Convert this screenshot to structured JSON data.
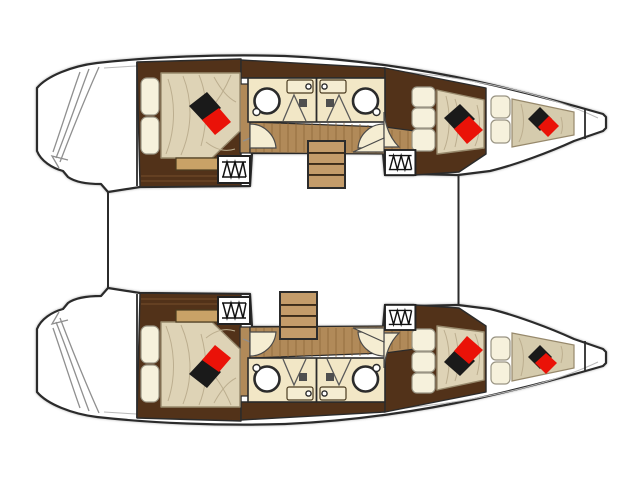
{
  "title": "Catamaran layout plan",
  "palette": {
    "line": "#2b2b2b",
    "hull_white": "#ffffff",
    "wenge": "#523219",
    "wenge_light": "#7a5230",
    "wood_mid": "#b18a59",
    "wood_grain": "#8a6335",
    "wood_step": "#c49c6a",
    "bench_wood": "#c9a267",
    "cream": "#f2e7c6",
    "door_cream": "#f5edd2",
    "mattress": "#ded3b6",
    "mattress_shade": "#bcae8f",
    "forepeak_pad": "#d5cbad",
    "pillow": "#f6f1dc",
    "pillow_line": "#9a9584",
    "cushion_black": "#1a1a1a",
    "cushion_red": "#ea1208",
    "square_gray": "#4f4f4f",
    "sketch_gray": "#8f8f8f"
  },
  "diagram": {
    "type": "yacht-deck-plan",
    "vessel": "sailing catamaran",
    "view": "top-down",
    "bows_facing": "right",
    "hulls": [
      {
        "id": "upper-hull",
        "rooms": [
          "stern platform with sketched steps",
          "aft double cabin",
          "aft bathroom with basin and shower",
          "forward bathroom with basin and shower",
          "corridor",
          "companionway stairs",
          "forward double cabin",
          "bow berth",
          "anchor locker"
        ]
      },
      {
        "id": "lower-hull",
        "rooms": [
          "stern platform with sketched steps",
          "aft double cabin",
          "aft bathroom with basin and shower",
          "forward bathroom with basin and shower",
          "corridor",
          "companionway stairs",
          "forward double cabin",
          "bow berth",
          "anchor locker"
        ]
      }
    ],
    "markers": {
      "bed_cushions": "black and red diamond cushions on every berth",
      "deck_hatch_symbol": "white box with zigzag ladder glyph",
      "door_symbol": "quarter-circle swing wedge",
      "sink_symbol": "round basin with faucet dot",
      "shower_symbol": "folded corner lines with gray drain square"
    },
    "counts": {
      "double_cabins": 4,
      "bow_berths": 2,
      "bathrooms": 4,
      "staircases": 2,
      "deck_hatches": 4
    }
  }
}
